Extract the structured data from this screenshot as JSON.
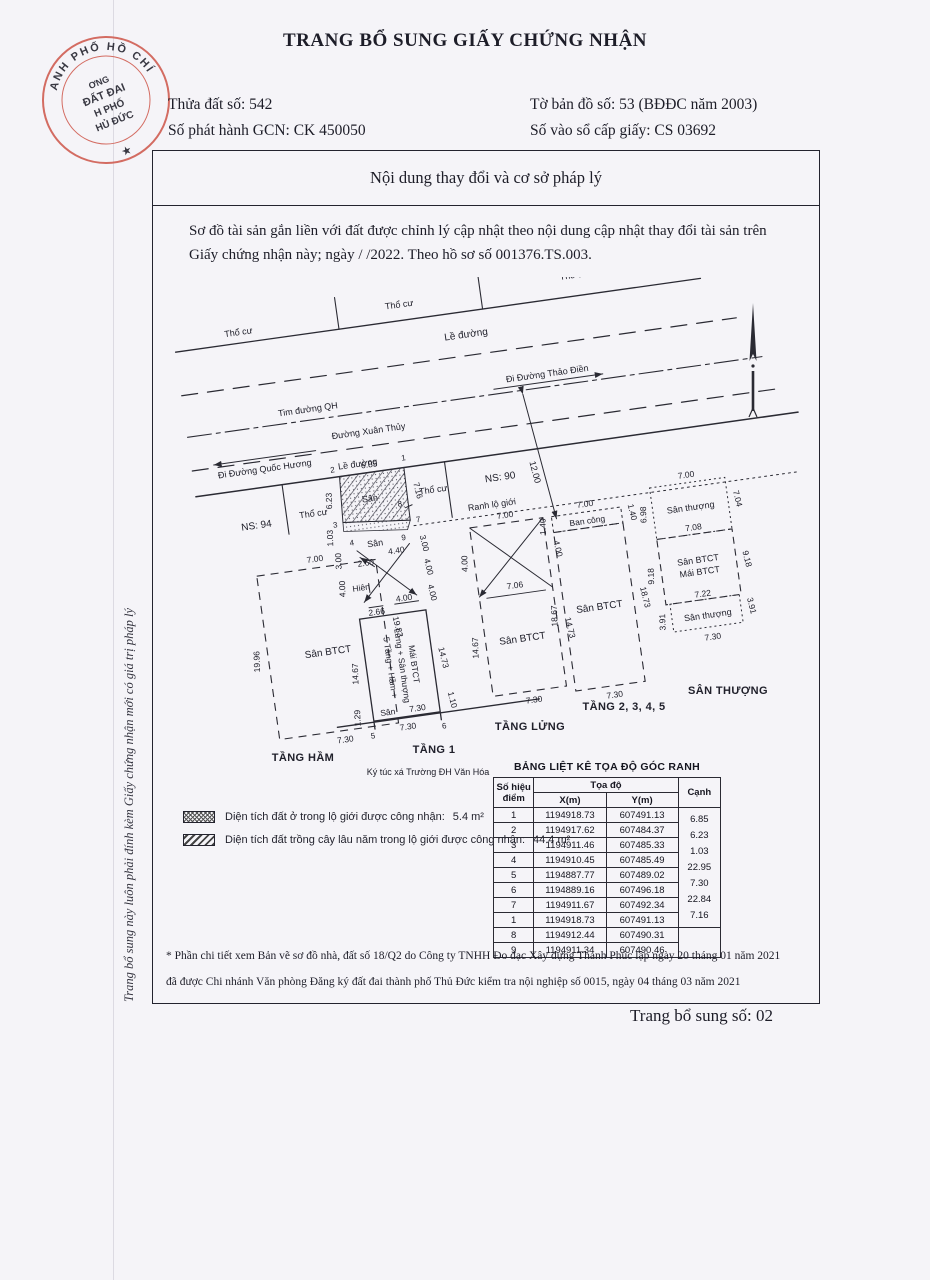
{
  "colors": {
    "paper": "#f5f4f8",
    "ink": "#1d1d28",
    "line": "#2a2a33",
    "stamp_red": "#cf5a4e"
  },
  "header": {
    "title": "TRANG BỔ SUNG GIẤY CHỨNG NHẬN",
    "parcel_no": "Thửa đất số: 542",
    "issue_no": "Số phát hành GCN: CK 450050",
    "map_no": "Tờ bản đồ số: 53 (BĐĐC năm 2003)",
    "book_no": "Số vào sổ cấp giấy: CS 03692"
  },
  "stamp": {
    "arc": "ANH PHỐ HỒ CHÍ MINH",
    "l1": "ƠNG",
    "l2": "ĐẤT ĐAI",
    "l3": "H PHỐ",
    "l4": "HỦ ĐỨC",
    "star": "★"
  },
  "side_note": "Trang bổ sung này luôn phải đính kèm Giấy chứng nhận mới có giá trị pháp lý",
  "box": {
    "title": "Nội dung thay đổi và cơ sở pháp lý",
    "paragraph": "Sơ đồ tài sản gắn liền với đất được chỉnh lý cập nhật theo nội dung cập nhật thay đổi tài sản trên Giấy chứng nhận này; ngày    /    /2022. Theo hồ sơ số 001376.TS.003."
  },
  "drawing": {
    "tho_cu_1": "Thổ cư",
    "tho_cu_2": "Thổ cư",
    "tho_cu_3": "Thổ cư",
    "le_duong_top": "Lề đường",
    "le_duong_bot": "Lề đường",
    "tim_duong_qh": "Tim đường QH",
    "di_thao_dien": "Đi Đường Thảo Điền",
    "duong_xuan_thuy": "Đường Xuân Thủy",
    "di_quoc_huong": "Đi Đường Quốc Hương",
    "road_width": "12.00",
    "ns94": "NS: 94",
    "ns90": "NS: 90",
    "tho_cu_left": "Thổ cư",
    "tho_cu_right": "Thổ cư",
    "ranh_lo_gioi": "Ranh lộ giới",
    "pt1": "1",
    "pt2": "2",
    "pt3": "3",
    "pt4": "4",
    "pt5": "5",
    "pt6": "6",
    "pt7": "7",
    "pt8": "8",
    "pt9": "9",
    "d685": "6.85",
    "d623": "6.23",
    "d716": "7.16",
    "d103": "1.03",
    "l_d300": "3.00",
    "l_d400": "4.00",
    "r_d300": "3.00",
    "r_d400a": "4.00",
    "r_d400b": "4.00",
    "san_hatch": "Sân",
    "san_yard": "Sân",
    "d440": "4.40",
    "d260": "2.60",
    "hien": "Hiên",
    "d266": "2.66",
    "d400c": "4.00",
    "bldg1": "5 Tầng + Hầm +",
    "bldg2": "Lửng + Sân thượng",
    "bldg3": "Mái BTCT",
    "d1467a": "14.67",
    "d1473a": "14.73",
    "d730a": "7.30",
    "d730b": "7.30",
    "san_rear": "Sân",
    "d129": "1.29",
    "d110": "1.10",
    "tang1": "TẦNG 1",
    "ktx": "Ký túc xá Trường ĐH Văn Hóa",
    "tang_ham": "TẦNG HẦM",
    "tang_lung": "TẦNG LỬNG",
    "tang2345": "TẦNG 2, 3, 4, 5",
    "san_thuong_lbl": "SÂN THƯỢNG",
    "bs_d700": "7.00",
    "bs_san": "Sân BTCT",
    "bs_d1996": "19.96",
    "bs_d1983": "19.83",
    "bs_d730": "7.30",
    "mz_d700": "7.00",
    "mz_d400l": "4.00",
    "mz_d400r": "4.00",
    "mz_d706": "7.06",
    "mz_san": "Sân BTCT",
    "mz_d1467": "14.67",
    "mz_d1473": "14.73",
    "mz_d730": "7.30",
    "fl_ban_cong": "Ban công",
    "fl_d700": "7.00",
    "fl_d140l": "1.40",
    "fl_d140r": "1.40",
    "fl_san": "Sân BTCT",
    "fl_d1867": "18.67",
    "fl_d1873": "18.73",
    "fl_d730": "7.30",
    "rf_san_top": "Sân thượng",
    "rf_d700": "7.00",
    "rf_d698": "6.98",
    "rf_d704": "7.04",
    "rf_d708": "7.08",
    "rf_san_btct": "Sân BTCT",
    "rf_mai_btct": "Mái BTCT",
    "rf_d918l": "9.18",
    "rf_d918r": "9.18",
    "rf_d722": "7.22",
    "rf_d391l": "3.91",
    "rf_d391r": "3.91",
    "rf_san_bot": "Sân thượng",
    "rf_d730": "7.30"
  },
  "legend": {
    "item1_label": "Diện tích đất ở trong lộ giới được công nhận:",
    "item1_value": "5.4 m²",
    "item2_label": "Diện tích đất trồng cây lâu năm trong lộ giới được công nhận:",
    "item2_value": "44.4 m²"
  },
  "table": {
    "title": "BẢNG LIỆT KÊ TỌA ĐỘ GÓC RANH",
    "col_point1": "Số hiệu",
    "col_point2": "điểm",
    "col_coord": "Tọa độ",
    "col_x": "X(m)",
    "col_y": "Y(m)",
    "col_edge": "Cạnh",
    "rows": [
      {
        "id": "1",
        "x": "1194918.73",
        "y": "607491.13"
      },
      {
        "id": "2",
        "x": "1194917.62",
        "y": "607484.37"
      },
      {
        "id": "3",
        "x": "1194911.46",
        "y": "607485.33"
      },
      {
        "id": "4",
        "x": "1194910.45",
        "y": "607485.49"
      },
      {
        "id": "5",
        "x": "1194887.77",
        "y": "607489.02"
      },
      {
        "id": "6",
        "x": "1194889.16",
        "y": "607496.18"
      },
      {
        "id": "7",
        "x": "1194911.67",
        "y": "607492.34"
      },
      {
        "id": "1b",
        "id_label": "1",
        "x": "1194918.73",
        "y": "607491.13"
      }
    ],
    "edges": [
      "6.85",
      "6.23",
      "1.03",
      "22.95",
      "7.30",
      "22.84",
      "7.16"
    ],
    "extra_rows": [
      {
        "id": "8",
        "x": "1194912.44",
        "y": "607490.31"
      },
      {
        "id": "9",
        "x": "1194911.34",
        "y": "607490.46"
      }
    ]
  },
  "footnote": {
    "line1": "* Phần chi tiết xem Bản vẽ sơ đồ nhà, đất số 18/Q2 do Công ty TNHH  Đo đạc Xây dựng Thanh Phúc lập ngày 20 tháng 01 năm 2021",
    "line2": "đã được Chi nhánh Văn phòng Đăng ký đất đai thành phố Thủ Đức kiểm tra nội nghiệp số 0015,  ngày 04 tháng 03 năm 2021"
  },
  "footer": {
    "page_label": "Trang bổ sung số: 02"
  }
}
